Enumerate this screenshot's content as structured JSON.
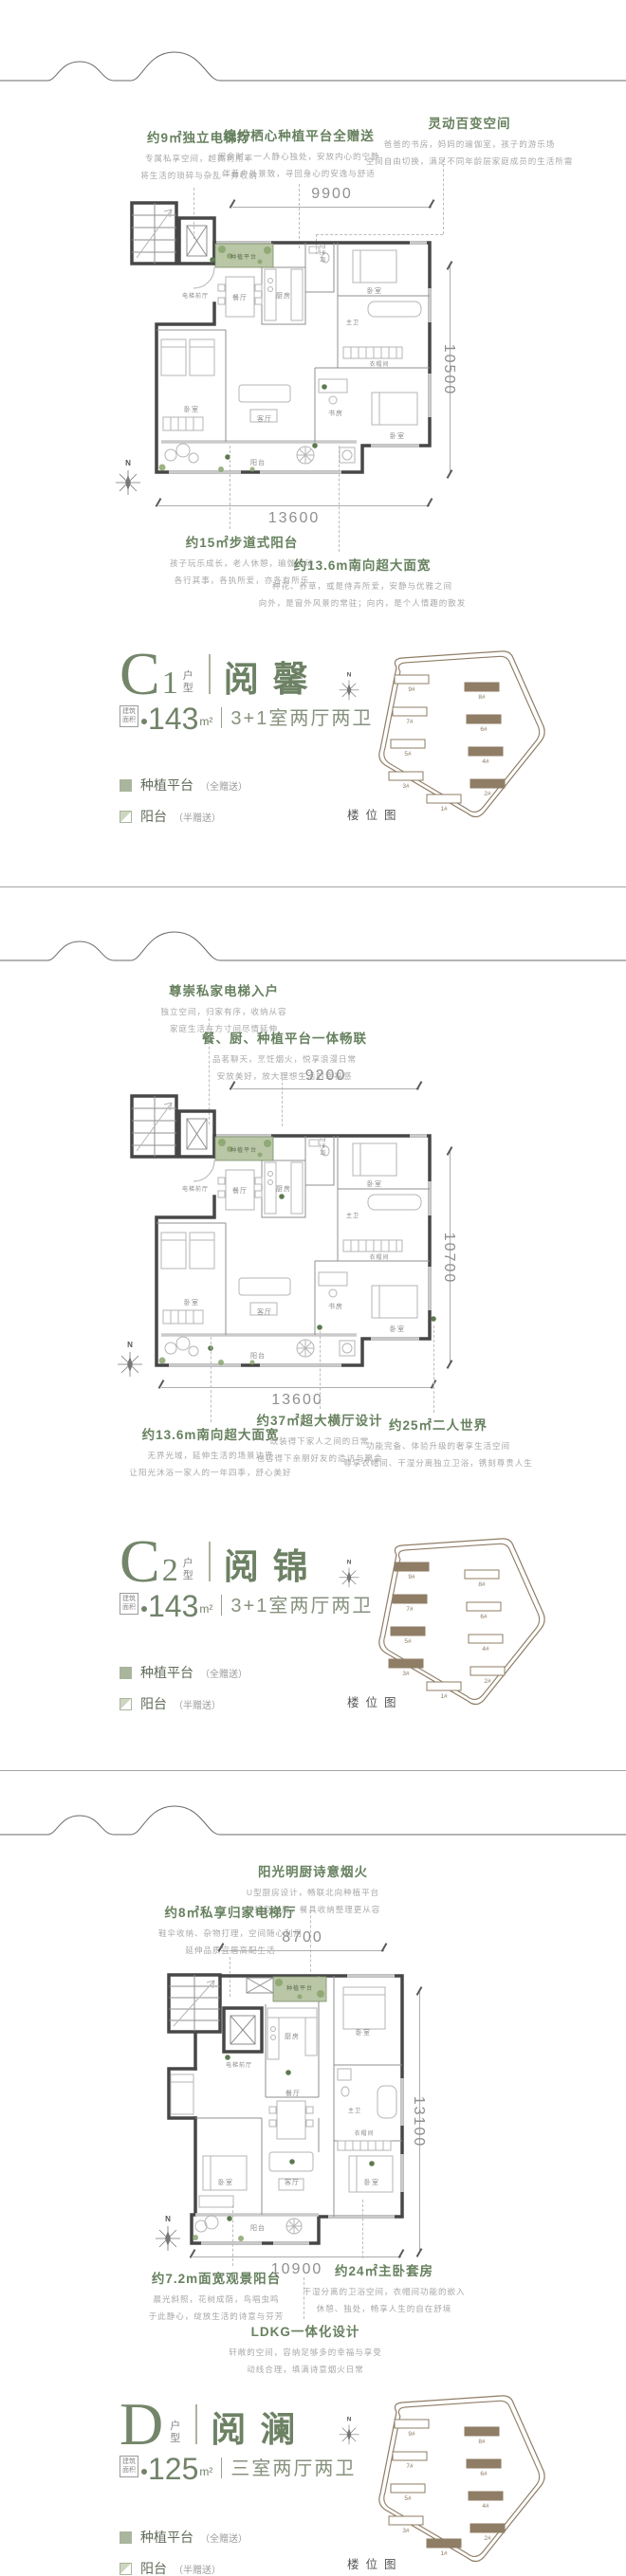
{
  "colors": {
    "accent_green": "#6d8164",
    "callout_green": "#67815f",
    "text_gray": "#a8a8a8",
    "wall_dark": "#474747",
    "planting_green": "#b9c7a6",
    "siteplan_brown": "#8f7d66"
  },
  "compass_label": "N",
  "siteplan": {
    "caption": "楼位图",
    "buildings": [
      "1#",
      "2#",
      "3#",
      "4#",
      "5#",
      "6#",
      "7#",
      "8#",
      "9#"
    ]
  },
  "legend": {
    "planting_label": "种植平台",
    "planting_note": "（全赠送）",
    "balcony_label": "阳台",
    "balcony_note": "（半赠送）"
  },
  "area_box": {
    "line1": "建筑",
    "line2": "面积"
  },
  "sections": [
    {
      "unit": {
        "letter": "C",
        "number": "1",
        "type_label": "户型",
        "name": "阅馨",
        "area_value": "143",
        "area_unit": "m²",
        "layout": "3+1室两厅两卫"
      },
      "dims": {
        "top": "9900",
        "right": "10500",
        "bottom": "13600"
      },
      "callouts_top": [
        {
          "title": "约9㎡独立电梯厅",
          "line1": "专属私享空间，超高利用率",
          "line2": "将生活的琐碎与杂乱一并收纳"
        },
        {
          "title": "缤纷栖心种植平台全赠送",
          "line1": "闲余时，一人静心独处，安放内心的宁静",
          "line2": "伴着户外景致，寻回身心的安逸与舒适"
        },
        {
          "title": "灵动百变空间",
          "line1": "爸爸的书房，妈妈的瑜伽室，孩子的游乐场",
          "line2": "空间自由切换，满足不同年龄层家庭成员的生活所需"
        }
      ],
      "callouts_bottom": [
        {
          "title": "约15㎡步道式阳台",
          "line1": "孩子玩乐成长，老人休憩，瑜伽运动",
          "line2": "各行其事，各执所爱，亦各有所乐"
        },
        {
          "title": "约13.6m南向超大面宽",
          "line1": "种花、养草，或是侍弄所爱，安静与优雅之间",
          "line2": "向外，是窗外风景的常驻；向内，是个人情趣的散发"
        }
      ],
      "rooms": {
        "elevator_hall": "电梯前厅",
        "planting": "种植平台",
        "dining": "餐厅",
        "kitchen": "厨房",
        "bath": "卫生间",
        "bedroom_a": "卧室",
        "master_bath": "主卫",
        "closet": "衣帽间",
        "bedroom_b": "卧室",
        "living": "客厅",
        "study": "书房",
        "bedroom_c": "卧室",
        "balcony": "阳台"
      }
    },
    {
      "unit": {
        "letter": "C",
        "number": "2",
        "type_label": "户型",
        "name": "阅锦",
        "area_value": "143",
        "area_unit": "m²",
        "layout": "3+1室两厅两卫"
      },
      "dims": {
        "top": "9200",
        "right": "10700",
        "bottom": "13600"
      },
      "callouts_top": [
        {
          "title": "尊崇私家电梯入户",
          "line1": "独立空间，归家有序，收纳从容",
          "line2": "家庭生活在方寸间尽情延伸"
        },
        {
          "title": "餐、厨、种植平台一体畅联",
          "line1": "品茗聊天，烹饪烟火，悦享浪漫日常",
          "line2": "安放美好，放大理想生活的幸福感"
        }
      ],
      "callouts_bottom": [
        {
          "title": "约13.6m南向超大面宽",
          "line1": "无界光域，延伸生活的场景边界",
          "line2": "让阳光沐浴一家人的一年四季，舒心美好"
        },
        {
          "title": "约37㎡超大横厅设计",
          "line1": "既装得下家人之间的日常",
          "line2": "也容得下亲朋好友的造访与聚会"
        },
        {
          "title": "约25㎡二人世界",
          "line1": "功能完备、体验升级的奢享生活空间",
          "line2": "尊享衣帽间、干湿分离独立卫浴，镌刻尊贵人生"
        }
      ],
      "rooms": {
        "elevator_hall": "电梯前厅",
        "planting": "种植平台",
        "dining": "餐厅",
        "kitchen": "厨房",
        "bath": "卫生间",
        "bedroom_a": "卧室",
        "master_bath": "主卫",
        "closet": "衣帽间",
        "bedroom_b": "卧室",
        "living": "客厅",
        "study": "书房",
        "bedroom_c": "卧室",
        "balcony": "阳台"
      }
    },
    {
      "unit": {
        "letter": "D",
        "number": "",
        "type_label": "户型",
        "name": "阅澜",
        "area_value": "125",
        "area_unit": "m²",
        "layout": "三室两厅两卫"
      },
      "dims": {
        "top": "8700",
        "right": "13100",
        "bottom": "10900"
      },
      "callouts_top": [
        {
          "title": "阳光明厨诗意烟火",
          "line1": "U型厨房设计，畅联北向种植平台",
          "line2": "双排型布局，餐具收纳整理更从容"
        },
        {
          "title": "约8㎡私享归家电梯厅",
          "line1": "鞋伞收纳、杂物打理，空间随心利用",
          "line2": "延伸品质宜居高配生活"
        }
      ],
      "callouts_bottom": [
        {
          "title": "约7.2m面宽观景阳台",
          "line1": "晨光斜照，花树成荫，鸟唱虫鸣",
          "line2": "于此静心，绽放生活的诗意与芬芳"
        },
        {
          "title": "约24㎡主卧套房",
          "line1": "干湿分离的卫浴空间，衣帽间功能的嵌入",
          "line2": "休憩、独处，畅享人生的自在舒境"
        },
        {
          "title": "LDKG一体化设计",
          "line1": "轩敞的空间，容纳足够多的幸福与享受",
          "line2": "动线合理，填满诗意烟火日常"
        }
      ],
      "rooms": {
        "elevator_hall": "电梯前厅",
        "planting": "种植平台",
        "kitchen": "厨房",
        "dining": "餐厅",
        "bedroom_a": "卧室",
        "master_bath": "主卫",
        "closet": "衣帽间",
        "bedroom_b": "卧室",
        "living": "客厅",
        "bedroom_c": "卧室",
        "balcony": "阳台"
      }
    }
  ]
}
